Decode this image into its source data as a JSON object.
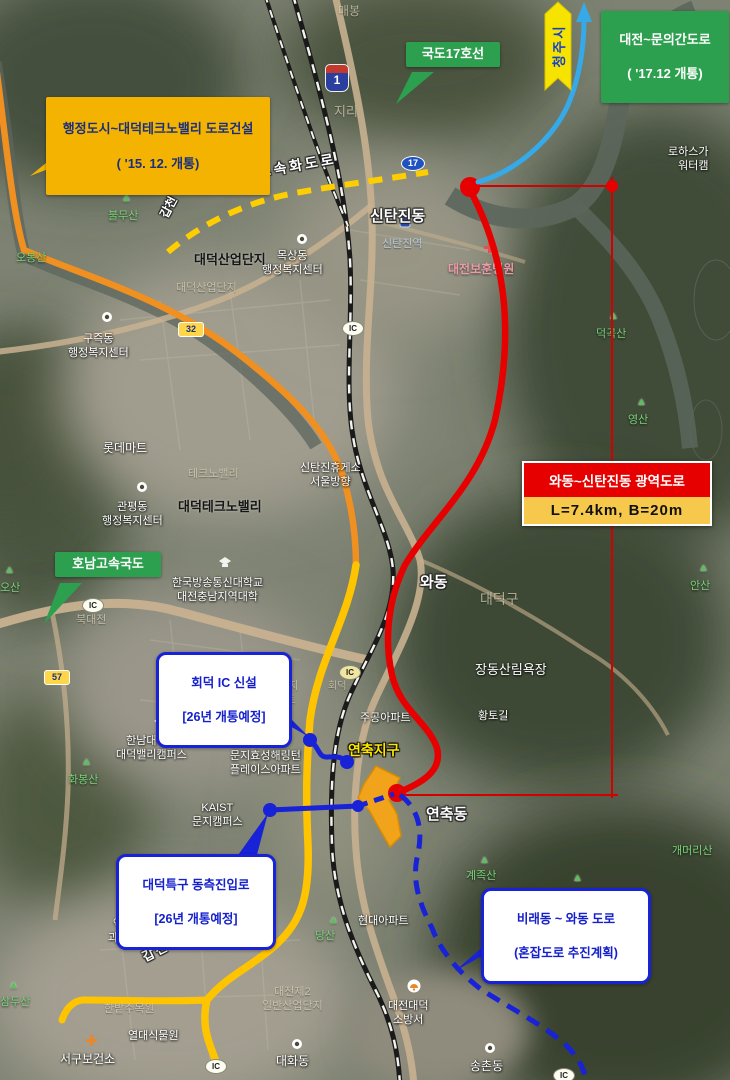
{
  "callouts": {
    "admin_city": {
      "line1": "행정도시~대덕테크노밸리 도로건설",
      "line2": "( '15. 12. 개통)"
    },
    "national17": {
      "label": "국도17호선"
    },
    "cheongju": {
      "label": "청주시"
    },
    "muni_road": {
      "line1": "대전~문의간도로",
      "line2": "( '17.12 개통)"
    },
    "metro_road": {
      "title": "와동~신탄진동 광역도로",
      "spec": "L=7.4km, B=20m"
    },
    "honam": {
      "label": "호남고속국도"
    },
    "hoedeok_ic": {
      "line1": "회덕 IC 신설",
      "line2": "[26년 개통예정]"
    },
    "east_entry": {
      "line1": "대덕특구 동측진입로",
      "line2": "[26년 개통예정]"
    },
    "birae": {
      "line1": "비래동 ~ 와동 도로",
      "line2": "(혼잡도로 추진계획)"
    }
  },
  "shields": {
    "expressway_1": "1",
    "national_17": "17",
    "local_32": "32",
    "local_57": "57",
    "ic": "IC"
  },
  "labels": {
    "maebong": "매봉",
    "jiri": "지리",
    "lohas": "로하스가\n워터캠",
    "sintanjin_dong": "신탄진동",
    "sintanjin_station": "신탄진역",
    "bohun_hospital": "대전보훈병원",
    "daedeok_industrial": "대덕산업단지",
    "daedeok_industrial_faint": "대덕산업단지",
    "moksang": "목상동\n행정복지센터",
    "gujeuk": "구즉동\n행정복지센터",
    "lotte_mart": "롯데마트",
    "technovalley_faint": "테크노밸리",
    "gwanpyeong": "관평동\n행정복지센터",
    "daedeok_technovalley": "대덕테크노밸리",
    "gapcheon_river": "갑천",
    "gapcheon_expwy_top": "갑천고속화도로",
    "sintanjin_rest": "신탄진휴게소\n서울방향",
    "hoedeok_faint": "회덕",
    "danji2_apt": "포2단지\n아파트",
    "jugong_apt": "주공아파트",
    "munji_apt": "문지효성해링턴\n플레이스아파트",
    "kaist": "KAIST\n문지캠퍼스",
    "knou": "한국방송통신대학교\n대전충남지역대학",
    "hannam": "한남대학교\n대덕밸리캠퍼스",
    "wadong": "와동",
    "daedeok_gu": "대덕구",
    "jangdong_forest": "장동산림욕장",
    "hwangtogil": "황토길",
    "yeonchuk_district": "연축지구",
    "yeonchuk_dong": "연축동",
    "gyejoksan": "계족산",
    "gaemeorisan": "개머리산",
    "dangsan": "당산",
    "hyundai_apt": "현대아파트",
    "expo_park": "엑스포\n과학공원",
    "gapcheon_expwy_bottom": "갑천고속화도로",
    "hanbat_arboretum": "한밭수목원",
    "tropical_garden": "열대식물원",
    "seogu_health": "서구보건소",
    "daehwa_dong": "대화동",
    "industrial2": "대전제2\n일반산업단지",
    "songchon_dong": "송촌동",
    "fire_station": "대전대덕\n소방서",
    "samdusan": "삼두산",
    "bulmusan": "불무산",
    "obongsan": "오봉산",
    "deokgoksan": "덕곡산",
    "yeongsan": "영산",
    "ansan": "안산",
    "osan": "오산",
    "hwabongsan": "화봉산",
    "bukdaejeon": "북대전",
    "triangle": "▲"
  },
  "colors": {
    "annotation_red": "#e60000",
    "annotation_blue": "#1822d6",
    "callout_green": "#2ca04e",
    "callout_yellow": "#f3b300",
    "spec_yellow": "#f6c94c",
    "road_orange": "#f09020",
    "road_yellow": "#ffc400",
    "arrow_light_blue": "#36a9e9",
    "district_orange": "#f5a418"
  }
}
